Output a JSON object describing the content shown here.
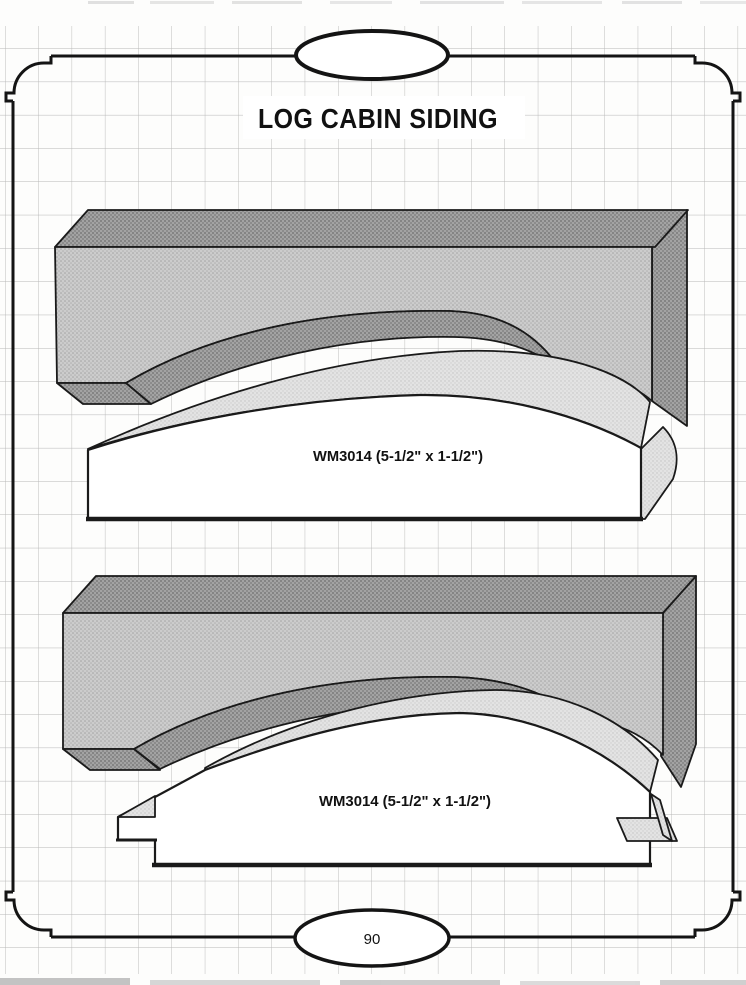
{
  "page": {
    "title": "LOG CABIN SIDING",
    "page_number": "90",
    "profiles": [
      {
        "id": "WM3014-plain",
        "label": "WM3014 (5-1/2\" x 1-1/2\")"
      },
      {
        "id": "WM3014-tongue",
        "label": "WM3014 (5-1/2\" x 1-1/2\")"
      }
    ],
    "colors": {
      "ink": "#111111",
      "paper": "#ffffff",
      "grid_line": "#b6b6b6",
      "shade_dark": "#949494",
      "shade_medium": "#c6c6c6",
      "shade_light": "#dedede"
    }
  }
}
